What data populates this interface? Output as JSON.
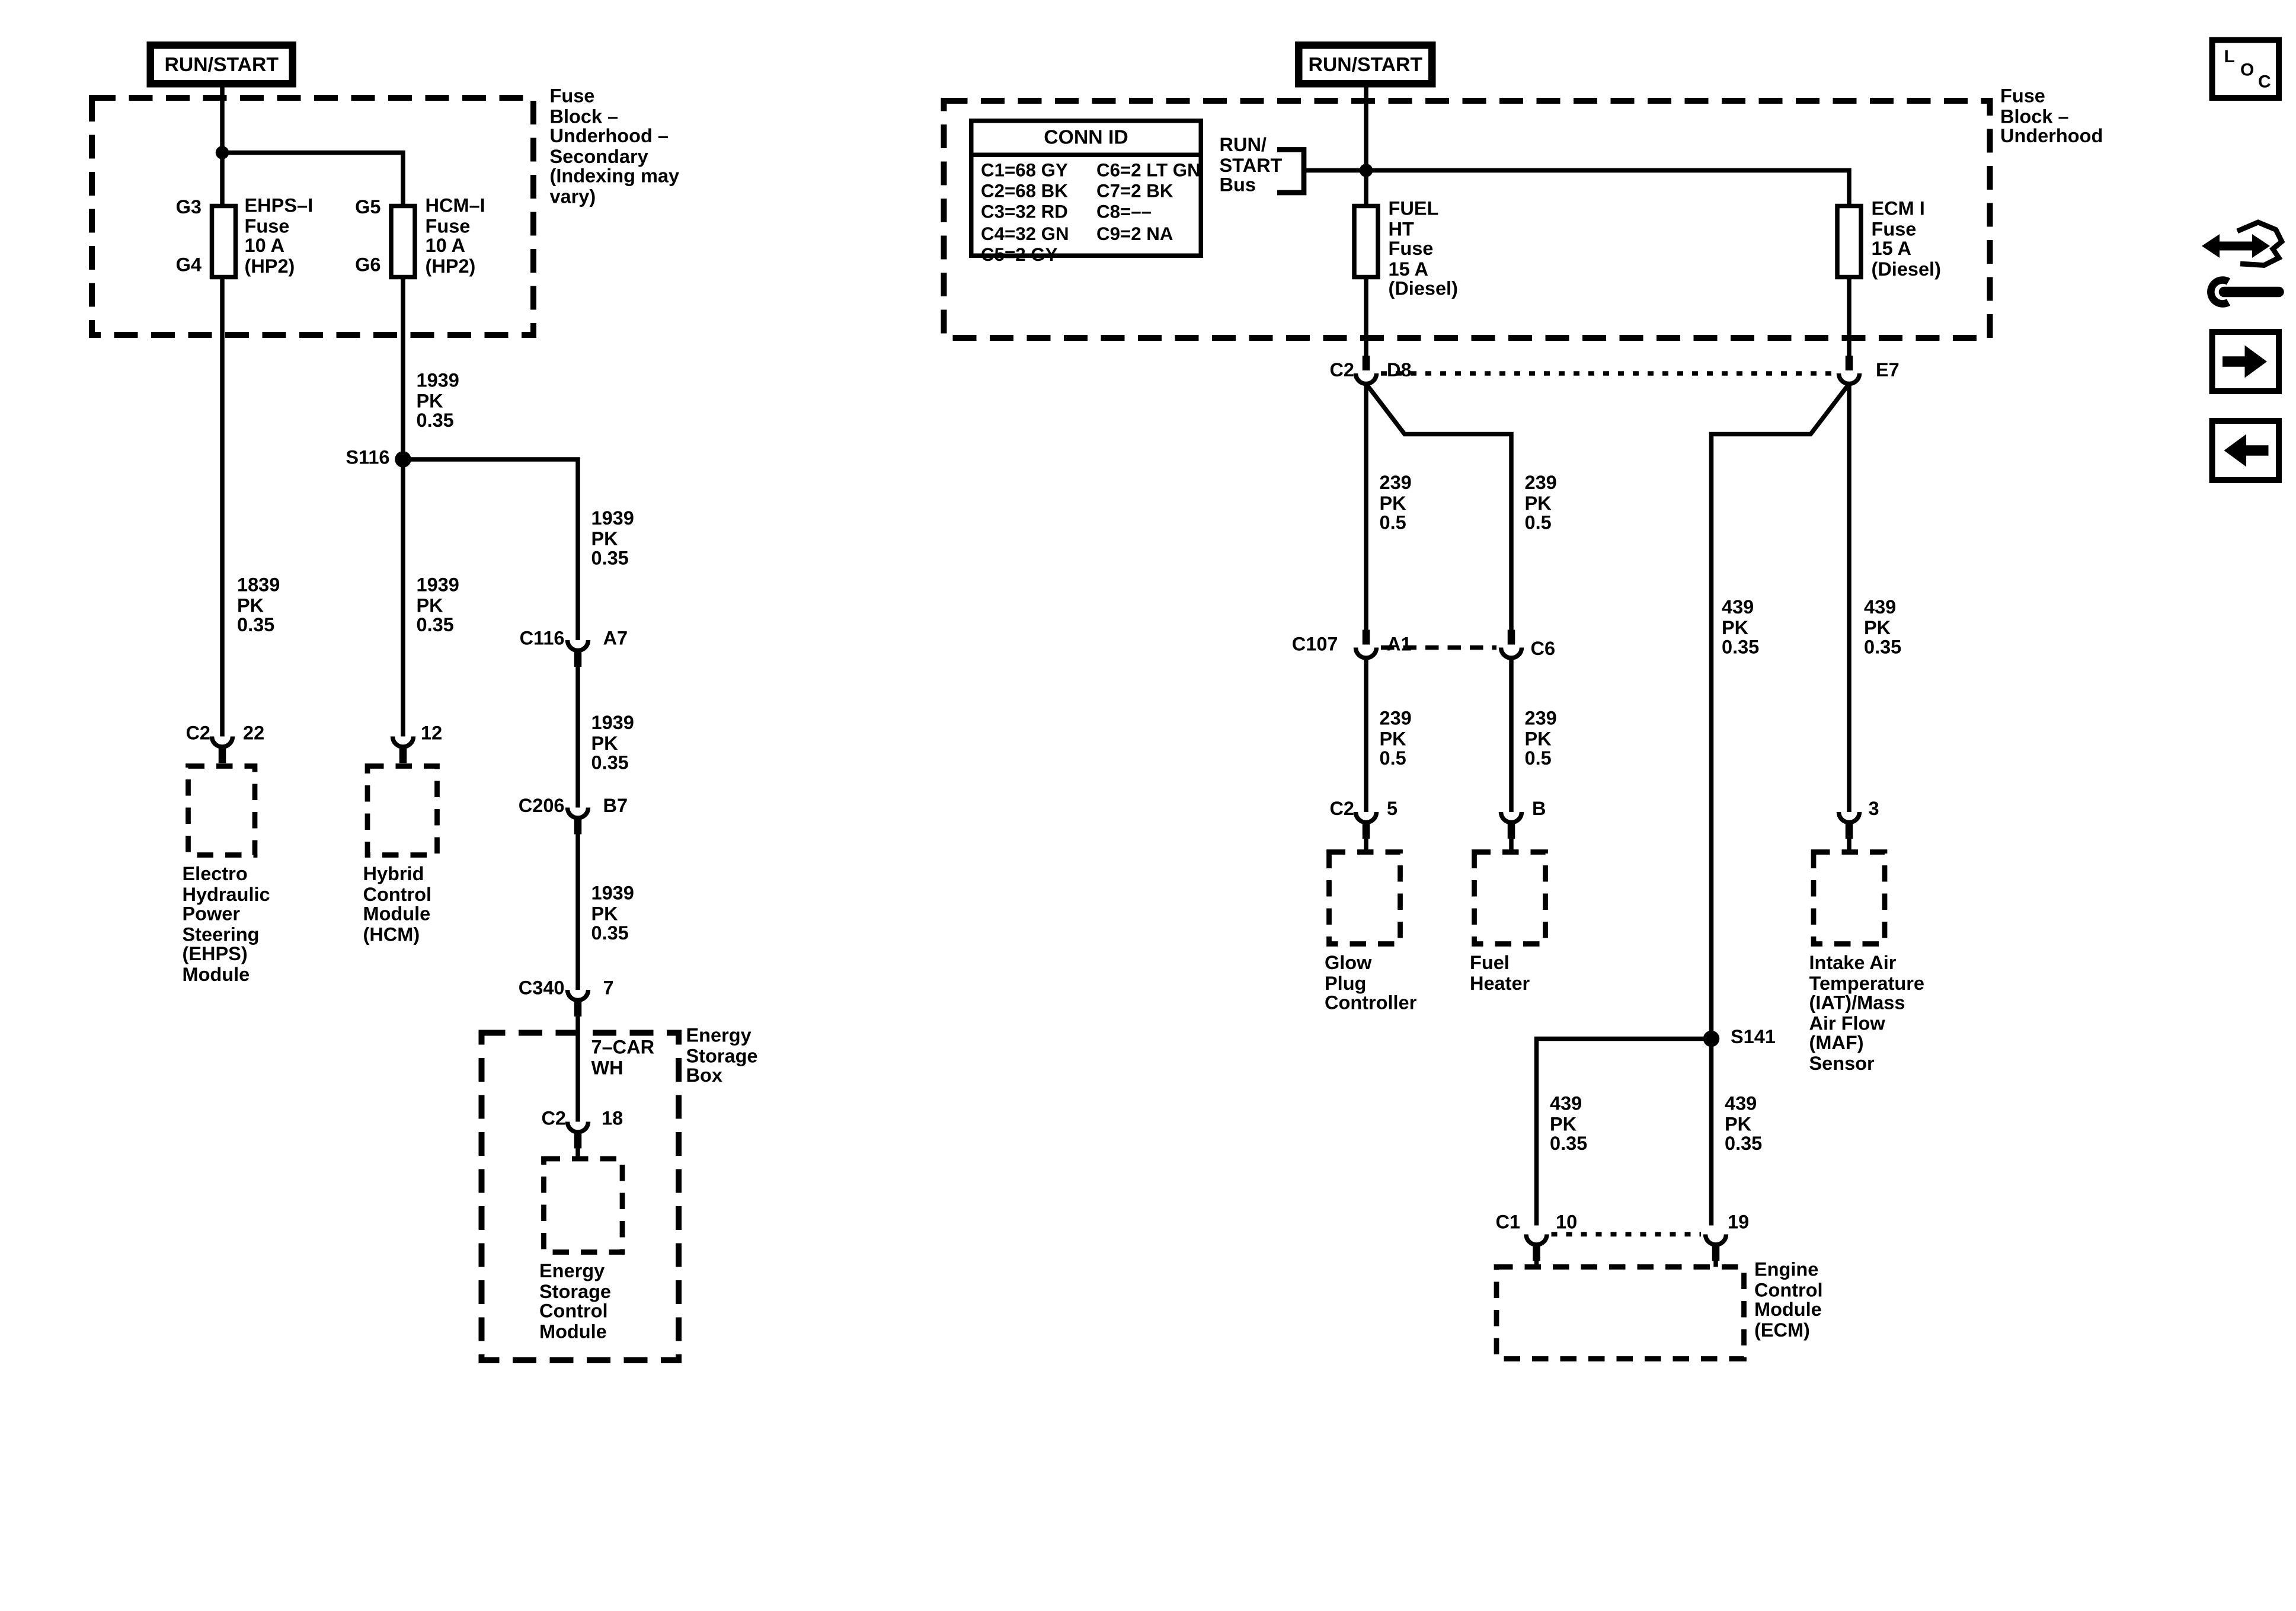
{
  "page": {
    "background": "#ffffff",
    "line_color": "#000000"
  },
  "toolbar": {
    "loc_button": {
      "l": "L",
      "o": "O",
      "c": "C"
    },
    "icons": {
      "nav": "wrench-double-arrow-icon",
      "forward": "right-arrow-icon",
      "back": "left-arrow-icon"
    }
  },
  "left": {
    "run_start_label": "RUN/START",
    "fuse_block_label": "Fuse\nBlock –\nUnderhood –\nSecondary\n(Indexing may\nvary)",
    "fuses": [
      {
        "pin_top": "G3",
        "pin_bottom": "G4",
        "label": "EHPS–I\nFuse\n10 A\n(HP2)"
      },
      {
        "pin_top": "G5",
        "pin_bottom": "G6",
        "label": "HCM–I\nFuse\n10 A\n(HP2)"
      }
    ],
    "splice": "S116",
    "wire_to_ehps": "1839\nPK\n0.35",
    "wire_fuse_to_s116": "1939\nPK\n0.35",
    "wire_s116_to_c116": "1939\nPK\n0.35",
    "wire_s116_to_hcm": "1939\nPK\n0.35",
    "wire_c116_to_c206": "1939\nPK\n0.35",
    "wire_c206_to_c340": "1939\nPK\n0.35",
    "wire_energy": "7–CAR\nWH",
    "conn_c116": {
      "name": "C116",
      "pin": "A7"
    },
    "conn_c206": {
      "name": "C206",
      "pin": "B7"
    },
    "conn_c340": {
      "name": "C340",
      "pin": "7"
    },
    "conn_ehps": {
      "name": "C2",
      "pin": "22"
    },
    "conn_hcm_pin": "12",
    "conn_escm": {
      "name": "C2",
      "pin": "18"
    },
    "module_ehps": "Electro\nHydraulic\nPower\nSteering\n(EHPS)\nModule",
    "module_hcm": "Hybrid\nControl\nModule\n(HCM)",
    "energy_box": "Energy\nStorage\nBox",
    "module_escm": "Energy\nStorage\nControl\nModule"
  },
  "right": {
    "run_start_label": "RUN/START",
    "fuse_block_label": "Fuse\nBlock –\nUnderhood",
    "conn_id": {
      "title": "CONN ID",
      "rows": [
        {
          "c1": "C1=68 GY",
          "c2": "C6=2 LT GN"
        },
        {
          "c1": "C2=68 BK",
          "c2": "C7=2 BK"
        },
        {
          "c1": "C3=32 RD",
          "c2": "C8=––"
        },
        {
          "c1": "C4=32 GN",
          "c2": "C9=2 NA"
        },
        {
          "c1": "C5=2 GY",
          "c2": ""
        }
      ]
    },
    "bus_label": "RUN/\nSTART\nBus",
    "fuse_fuel": "FUEL\nHT\nFuse\n15 A\n(Diesel)",
    "fuse_ecm": "ECM I\nFuse\n15 A\n(Diesel)",
    "conn_d8": {
      "name": "C2",
      "pin": "D8"
    },
    "pin_e7": "E7",
    "wire_d8_a1": "239\nPK\n0.5",
    "wire_d8_c6": "239\nPK\n0.5",
    "conn_c107": {
      "name": "C107",
      "pin_a": "A1",
      "pin_b": "C6"
    },
    "wire_a1_glow": "239\nPK\n0.5",
    "wire_c6_heater": "239\nPK\n0.5",
    "conn_glow": {
      "name": "C2",
      "pin": "5"
    },
    "module_glow": "Glow\nPlug\nController",
    "pin_b": "B",
    "module_heater": "Fuel\nHeater",
    "wire_e7_s141": "439\nPK\n0.35",
    "wire_e7_iat": "439\nPK\n0.35",
    "pin_3": "3",
    "module_iat": "Intake Air\nTemperature\n(IAT)/Mass\nAir Flow\n(MAF)\nSensor",
    "splice": "S141",
    "wire_s141_10": "439\nPK\n0.35",
    "wire_s141_19": "439\nPK\n0.35",
    "conn_ecm": {
      "name": "C1",
      "pin_a": "10",
      "pin_b": "19"
    },
    "module_ecm": "Engine\nControl\nModule\n(ECM)"
  }
}
